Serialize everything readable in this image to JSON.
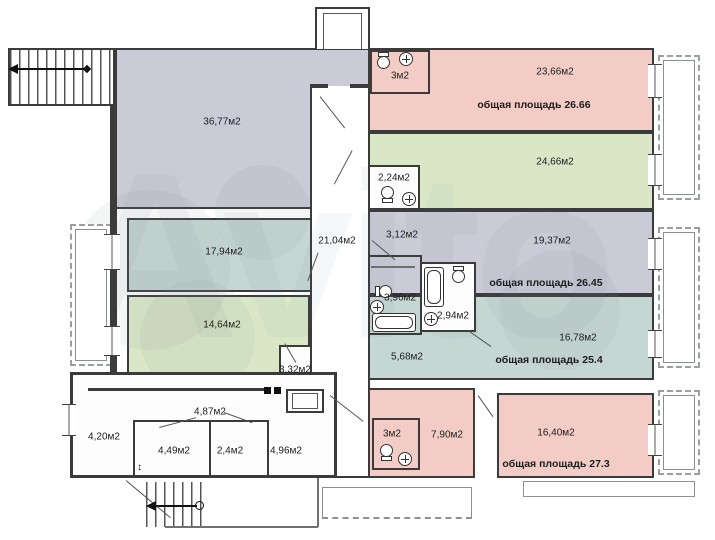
{
  "watermark": "Avito",
  "colors": {
    "room_lavender": "#cbcad7",
    "room_teal": "#c5d7d3",
    "room_green": "#d9e7c7",
    "room_salmon": "#f3cdc5",
    "wall": "#3b3b3b",
    "balcony_outline": "#9aa0a0"
  },
  "rooms": {
    "big": "36,77м2",
    "teal_mid": "17,94м2",
    "green_mid": "14,64м2",
    "closet": "3,32м2",
    "corridor": "21,04м2"
  },
  "apartments": [
    {
      "bath": "3м2",
      "room": "23,66м2",
      "total": "общая площадь 26.66"
    },
    {
      "bath": "2,24м2",
      "room": "24,66м2"
    },
    {
      "hall": "3,12м2",
      "room": "19,37м2",
      "bath": "3,96м2",
      "total": "общая площадь 26.45"
    },
    {
      "bath": "2,94м2",
      "room": "16,78м2",
      "hall": "5,68м2",
      "total": "общая площадь 25.4"
    },
    {
      "bath": "3м2",
      "hall": "7,90м2",
      "room": "16,40м2",
      "total": "общая площадь 27.3"
    }
  ],
  "wing_rooms": {
    "a": "4,20м2",
    "b": "4,49м2",
    "c": "2,4м2",
    "d": "4,87м2",
    "e": "4,96м2"
  }
}
